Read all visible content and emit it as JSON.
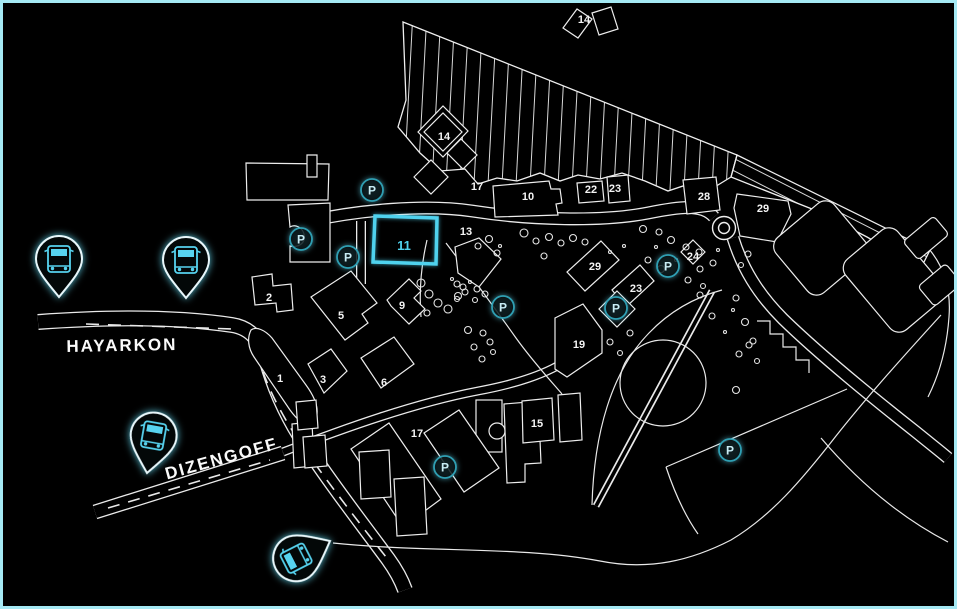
{
  "map": {
    "colors": {
      "background": "#000000",
      "frame": "#a5e9f4",
      "line": "#ededed",
      "accent": "#4fd2ee",
      "parking_ring": "#2f9fb3",
      "parking_letter": "#c8ecf4"
    },
    "street_labels": [
      {
        "text": "HAYARKON",
        "x": 122,
        "y": 351,
        "rotation": -1
      },
      {
        "text": "DIZENGOFF",
        "x": 223,
        "y": 464,
        "rotation": -15.5
      }
    ],
    "highlighted_building": {
      "number": "11",
      "label_x": 404,
      "label_y": 250
    },
    "building_labels": [
      {
        "text": "1",
        "x": 280,
        "y": 382
      },
      {
        "text": "2",
        "x": 269,
        "y": 301
      },
      {
        "text": "3",
        "x": 323,
        "y": 383
      },
      {
        "text": "5",
        "x": 341,
        "y": 319
      },
      {
        "text": "6",
        "x": 384,
        "y": 386
      },
      {
        "text": "9",
        "x": 402,
        "y": 309
      },
      {
        "text": "10",
        "x": 528,
        "y": 200
      },
      {
        "text": "13",
        "x": 466,
        "y": 235
      },
      {
        "text": "14",
        "x": 584,
        "y": 23
      },
      {
        "text": "14",
        "x": 444,
        "y": 140
      },
      {
        "text": "15",
        "x": 537,
        "y": 427
      },
      {
        "text": "17",
        "x": 477,
        "y": 190
      },
      {
        "text": "17",
        "x": 417,
        "y": 437
      },
      {
        "text": "19",
        "x": 579,
        "y": 348
      },
      {
        "text": "22",
        "x": 591,
        "y": 193
      },
      {
        "text": "23",
        "x": 615,
        "y": 192
      },
      {
        "text": "23",
        "x": 636,
        "y": 292
      },
      {
        "text": "24",
        "x": 693,
        "y": 260
      },
      {
        "text": "28",
        "x": 704,
        "y": 200
      },
      {
        "text": "29",
        "x": 763,
        "y": 212
      },
      {
        "text": "29",
        "x": 595,
        "y": 270
      }
    ],
    "parking_markers": {
      "letter": "P",
      "positions": [
        [
          372,
          190
        ],
        [
          301,
          239
        ],
        [
          348,
          257
        ],
        [
          503,
          307
        ],
        [
          616,
          308
        ],
        [
          668,
          266
        ],
        [
          445,
          467
        ],
        [
          730,
          450
        ]
      ]
    },
    "bus_stops": [
      {
        "x": 59,
        "y": 297,
        "rotation": 0
      },
      {
        "x": 186,
        "y": 298,
        "rotation": 0
      },
      {
        "x": 147,
        "y": 473,
        "rotation": 10
      },
      {
        "x": 330,
        "y": 541,
        "rotation": -117
      }
    ],
    "trees": [
      [
        421,
        283,
        4
      ],
      [
        429,
        294,
        4
      ],
      [
        438,
        303,
        4
      ],
      [
        448,
        309,
        4
      ],
      [
        427,
        313,
        3
      ],
      [
        458,
        296,
        3.5
      ],
      [
        463,
        287,
        3
      ],
      [
        489,
        239,
        3.5
      ],
      [
        478,
        246,
        3
      ],
      [
        497,
        253,
        3
      ],
      [
        524,
        233,
        4
      ],
      [
        536,
        241,
        3
      ],
      [
        549,
        237,
        3.5
      ],
      [
        561,
        243,
        3
      ],
      [
        573,
        238,
        3.5
      ],
      [
        585,
        242,
        3
      ],
      [
        457,
        284,
        3
      ],
      [
        465,
        292,
        3
      ],
      [
        477,
        289,
        3
      ],
      [
        485,
        294,
        3
      ],
      [
        457,
        299,
        2.5
      ],
      [
        475,
        300,
        2.5
      ],
      [
        468,
        330,
        3.5
      ],
      [
        483,
        333,
        3
      ],
      [
        490,
        342,
        3
      ],
      [
        474,
        347,
        3
      ],
      [
        493,
        352,
        2.5
      ],
      [
        482,
        359,
        3
      ],
      [
        643,
        229,
        3.5
      ],
      [
        659,
        232,
        3
      ],
      [
        671,
        240,
        3.5
      ],
      [
        686,
        247,
        3
      ],
      [
        699,
        252,
        3
      ],
      [
        648,
        260,
        3
      ],
      [
        661,
        269,
        3.5
      ],
      [
        700,
        269,
        3
      ],
      [
        713,
        263,
        3
      ],
      [
        688,
        280,
        3
      ],
      [
        703,
        286,
        2.5
      ],
      [
        748,
        254,
        3
      ],
      [
        741,
        265,
        2.5
      ],
      [
        745,
        322,
        3.5
      ],
      [
        753,
        341,
        3
      ],
      [
        739,
        354,
        3
      ],
      [
        757,
        361,
        2.5
      ],
      [
        700,
        295,
        3
      ],
      [
        736,
        298,
        3
      ],
      [
        712,
        316,
        3
      ],
      [
        749,
        345,
        3
      ],
      [
        736,
        390,
        3.5
      ],
      [
        610,
        342,
        3
      ],
      [
        620,
        353,
        2.5
      ],
      [
        630,
        333,
        3
      ],
      [
        544,
        256,
        3
      ],
      [
        452,
        279,
        1.5
      ],
      [
        470,
        282,
        1.5
      ],
      [
        500,
        246,
        1.5
      ],
      [
        610,
        252,
        1.5
      ],
      [
        624,
        246,
        1.5
      ],
      [
        656,
        247,
        1.5
      ],
      [
        676,
        260,
        1.5
      ],
      [
        718,
        250,
        1.5
      ],
      [
        733,
        310,
        1.5
      ],
      [
        725,
        332,
        1.5
      ]
    ]
  }
}
